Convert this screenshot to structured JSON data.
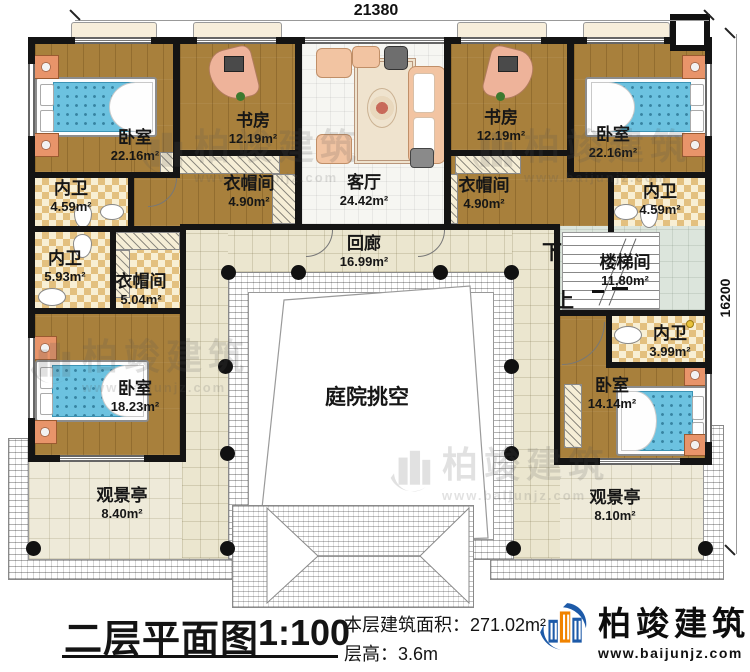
{
  "dimensions": {
    "top": "21380",
    "right": "16200"
  },
  "titleblock": {
    "title": "二层平面图",
    "scale": "1:100",
    "area": "本层建筑面积：271.02m²",
    "floor_height": "层高：3.6m"
  },
  "logo": {
    "name": "柏竣建筑",
    "url": "www.baijunjz.com"
  },
  "watermark": {
    "name": "柏竣建筑",
    "url": "www.baijunjz.com"
  },
  "stairs": {
    "down": "下",
    "up": "上"
  },
  "rooms": {
    "bedroom_tl": {
      "name": "卧室",
      "area": "22.16m²"
    },
    "study_l": {
      "name": "书房",
      "area": "12.19m²"
    },
    "living": {
      "name": "客厅",
      "area": "24.42m²"
    },
    "study_r": {
      "name": "书房",
      "area": "12.19m²"
    },
    "bedroom_tr": {
      "name": "卧室",
      "area": "22.16m²"
    },
    "bath_tl": {
      "name": "内卫",
      "area": "4.59m²"
    },
    "closet_l": {
      "name": "衣帽间",
      "area": "4.90m²"
    },
    "closet_r": {
      "name": "衣帽间",
      "area": "4.90m²"
    },
    "bath_tr": {
      "name": "内卫",
      "area": "4.59m²"
    },
    "corridor": {
      "name": "回廊",
      "area": "16.99m²"
    },
    "bath_ml": {
      "name": "内卫",
      "area": "5.93m²"
    },
    "closet_ml": {
      "name": "衣帽间",
      "area": "5.04m²"
    },
    "stairwell": {
      "name": "楼梯间",
      "area": "11.80m²"
    },
    "bath_mr": {
      "name": "内卫",
      "area": "3.99m²"
    },
    "bedroom_bl": {
      "name": "卧室",
      "area": "18.23m²"
    },
    "bedroom_br": {
      "name": "卧室",
      "area": "14.14m²"
    },
    "courtyard": {
      "name": "庭院挑空",
      "area": ""
    },
    "pavilion_l": {
      "name": "观景亭",
      "area": "8.40m²"
    },
    "pavilion_r": {
      "name": "观景亭",
      "area": "8.10m²"
    }
  }
}
